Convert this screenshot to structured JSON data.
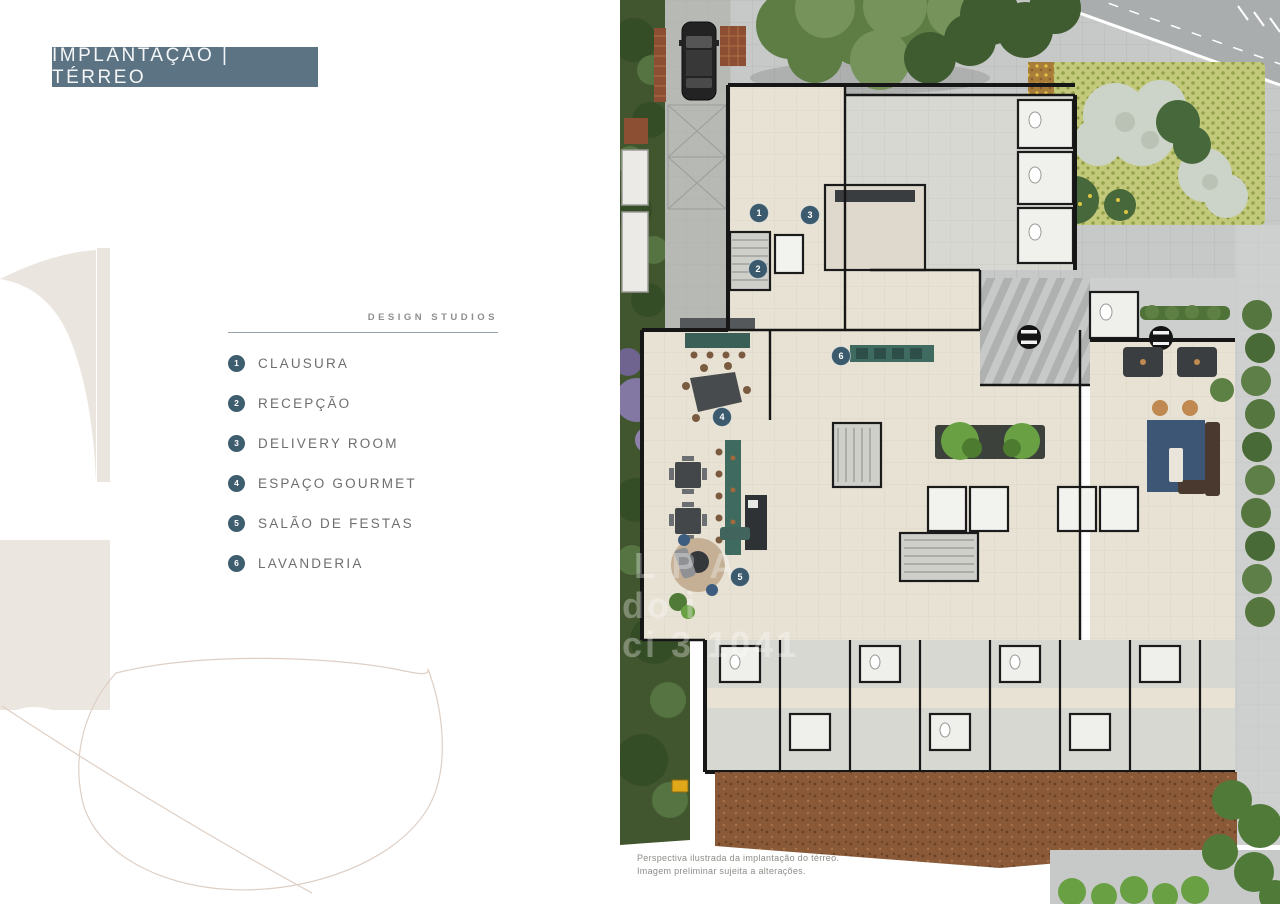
{
  "header": {
    "title": "IMPLANTAÇÃO | TÉRREO"
  },
  "legend": {
    "heading": "DESIGN STUDIOS",
    "items": [
      {
        "number": "1",
        "label": "CLAUSURA"
      },
      {
        "number": "2",
        "label": "RECEPÇÃO"
      },
      {
        "number": "3",
        "label": "DELIVERY ROOM"
      },
      {
        "number": "4",
        "label": "ESPAÇO GOURMET"
      },
      {
        "number": "5",
        "label": "SALÃO DE FESTAS"
      },
      {
        "number": "6",
        "label": "LAVANDERIA"
      }
    ]
  },
  "plan": {
    "markers": [
      {
        "number": "1",
        "x": 139,
        "y": 213
      },
      {
        "number": "2",
        "x": 138,
        "y": 269
      },
      {
        "number": "3",
        "x": 190,
        "y": 215
      },
      {
        "number": "4",
        "x": 102,
        "y": 417
      },
      {
        "number": "5",
        "x": 120,
        "y": 577
      },
      {
        "number": "6",
        "x": 221,
        "y": 356
      }
    ],
    "watermark_fragments": [
      {
        "text": "L P A",
        "x": 14,
        "y": 578
      },
      {
        "text": "do i",
        "x": 2,
        "y": 618
      },
      {
        "text": "ci 3 1041",
        "x": 2,
        "y": 657
      }
    ],
    "caption_line1": "Perspectiva ilustrada da implantação do térreo.",
    "caption_line2": "Imagem preliminar sujeita a alterações."
  },
  "colors": {
    "accent": "#5c7383",
    "legend_badge": "#3e5d6f",
    "marker": "#3b5a6d",
    "mulch": "#8a5a38",
    "counter_teal": "#3f6a60",
    "rug_blue": "#3d5675"
  }
}
